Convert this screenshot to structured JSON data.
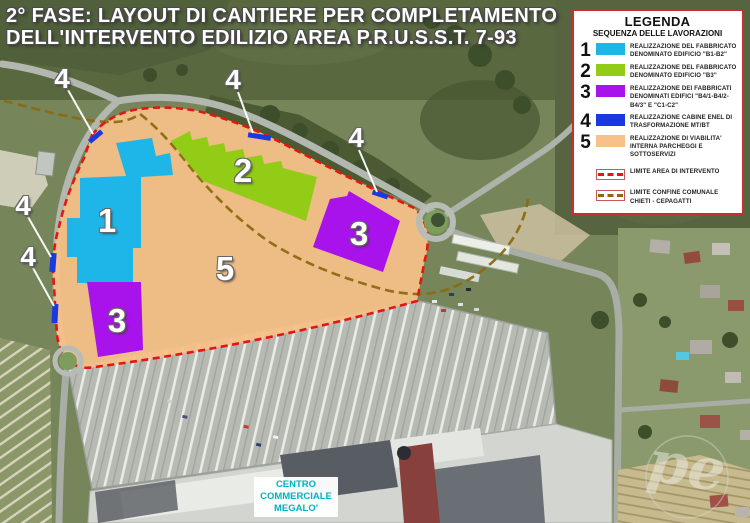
{
  "title": {
    "line1": "2° FASE: LAYOUT DI CANTIERE PER COMPLETAMENTO",
    "line2": "DELL'INTERVENTO EDILIZIO AREA P.R.U.S.S.T. 7-93"
  },
  "legend": {
    "title": "LEGENDA",
    "subtitle": "SEQUENZA DELLE LAVORAZIONI",
    "items": [
      {
        "num": "1",
        "color": "#1eb6e8",
        "label": "REALIZZAZIONE DEL FABBRICATO DENOMINATO EDIFICIO \"B1-B2\""
      },
      {
        "num": "2",
        "color": "#93cc17",
        "label": "REALIZZAZIONE DEL FABBRICATO DENOMINATO EDIFICIO \"B3\""
      },
      {
        "num": "3",
        "color": "#a713ea",
        "label": "REALIZZAZIONE DEI FABBRICATI DENOMINATI EDIFICI \"B4/1-B4/2-B4/3\" E \"C1-C2\""
      },
      {
        "num": "4",
        "color": "#1a3ae0",
        "label": "REALIZZAZIONE CABINE ENEL DI TRASFORMAZIONE MT/BT"
      },
      {
        "num": "5",
        "color": "#f7c189",
        "label": "REALIZZAZIONE DI VIABILITA' INTERNA PARCHEGGI E SOTTOSERVIZI"
      }
    ],
    "lines": [
      {
        "color": "#e41710",
        "label": "LIMITE AREA DI INTERVENTO"
      },
      {
        "color": "#8a6a10",
        "label": "LIMITE CONFINE COMUNALE CHIETI - CEPAGATTI"
      }
    ]
  },
  "map": {
    "zone_labels": {
      "zone1": "1",
      "zone2": "2",
      "zone3_west": "3",
      "zone3_east": "3",
      "zone5": "5"
    },
    "cabin_markers": [
      "4",
      "4",
      "4",
      "4",
      "4"
    ],
    "mall_label": "CENTRO COMMERCIALE MEGALO'"
  },
  "watermark": {
    "letters": "pe"
  }
}
